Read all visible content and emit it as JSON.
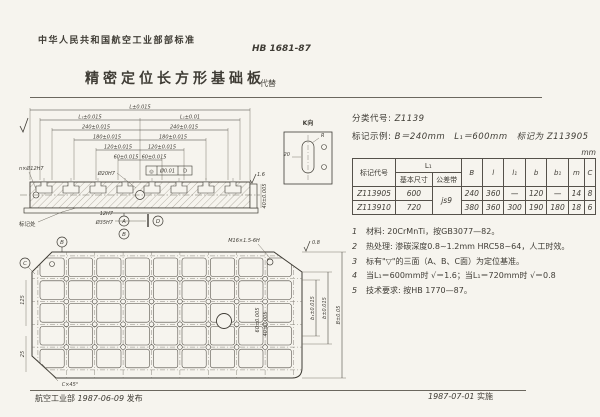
{
  "page": {
    "bg": "#f6f4ee",
    "ink": "#3f3c35"
  },
  "header": {
    "org": "中华人民共和国航空工业部部标准",
    "std_no": "HB 1681-87",
    "title": "精密定位长方形基础板",
    "replaces_label": "代替"
  },
  "info": {
    "class_label": "分类代号:",
    "class_value": "Z1139",
    "example_label": "标记示例:",
    "example_value": "B＝240mm　L₁＝600mm　标记为 Z113905",
    "unit": "mm"
  },
  "table": {
    "h_code": "标记代号",
    "h_l1": "L₁",
    "h_l1_basic": "基本尺寸",
    "h_l1_tol": "公差带",
    "h_B": "B",
    "h_l": "l",
    "h_l1b": "l₁",
    "h_b": "b",
    "h_b1": "b₁",
    "h_m": "m",
    "h_C": "C",
    "tol_shared": "js9",
    "rows": [
      {
        "code": "Z113905",
        "l1": "600",
        "B": "240",
        "l": "360",
        "l1b": "—",
        "b": "120",
        "b1": "—",
        "m": "14",
        "C": "8"
      },
      {
        "code": "Z113910",
        "l1": "720",
        "B": "380",
        "l": "360",
        "l1b": "300",
        "b": "190",
        "b1": "180",
        "m": "18",
        "C": "6"
      }
    ]
  },
  "notes": [
    {
      "num": "1",
      "text": "材料: 20CrMnTi，按GB3077—82。"
    },
    {
      "num": "2",
      "text": "热处理: 渗碳深度0.8~1.2mm HRC58~64，人工时效。"
    },
    {
      "num": "3",
      "text": "标有\"▽\"的三面（A、B、C面）为定位基准。"
    },
    {
      "num": "4",
      "text": "当L₁＝600mm时 √＝1.6；当L₁＝720mm时 √＝0.8"
    },
    {
      "num": "5",
      "text": "技术要求: 按HB 1770—87。"
    }
  ],
  "footer": {
    "left_org": "航空工业部",
    "left_date": "1987-06-09",
    "left_pub": "发布",
    "right_date": "1987-07-01",
    "right_impl": "实施"
  },
  "drawing": {
    "side": {
      "dim_L": "L±0.015",
      "dim_L1_l": "L₁±0.015",
      "dim_L1_r": "L₁±0.01",
      "dim_240_l": "240±0.015",
      "dim_240_r": "240±0.015",
      "dim_180_l": "180±0.015",
      "dim_180_r": "180±0.015",
      "dim_120_l": "120±0.015",
      "dim_120_r": "120±0.015",
      "dim_60_l": "60±0.015",
      "dim_60_r": "60±0.015",
      "hole_label": "n×Ø12H7",
      "center_hole": "Ø20H7",
      "fcf_sym": "◎",
      "fcf_tol": "Ø0.01",
      "fcf_datum": "D",
      "mark_label": "标记处",
      "datum_a": "A",
      "datum_b": "B",
      "datum_d": "D",
      "bore_small": "12H7",
      "bore_big": "Ø35H7",
      "end_dim": "40±0.005",
      "rough_end": "1.6"
    },
    "kview": {
      "title": "K向",
      "r_label": "R",
      "dim_20": "20"
    },
    "plan": {
      "thread": "M16×1.5-6H",
      "chamfer": "C×45°",
      "datum_b": "B",
      "datum_c": "C",
      "dim_b1": "b₁±0.015",
      "dim_b": "b±0.015",
      "dim_B": "B±0.05",
      "rough": "0.8",
      "left_dim1": "125",
      "left_dim2": "25",
      "inner_dim1": "60±0.005",
      "inner_dim2": "40±0.005"
    }
  }
}
